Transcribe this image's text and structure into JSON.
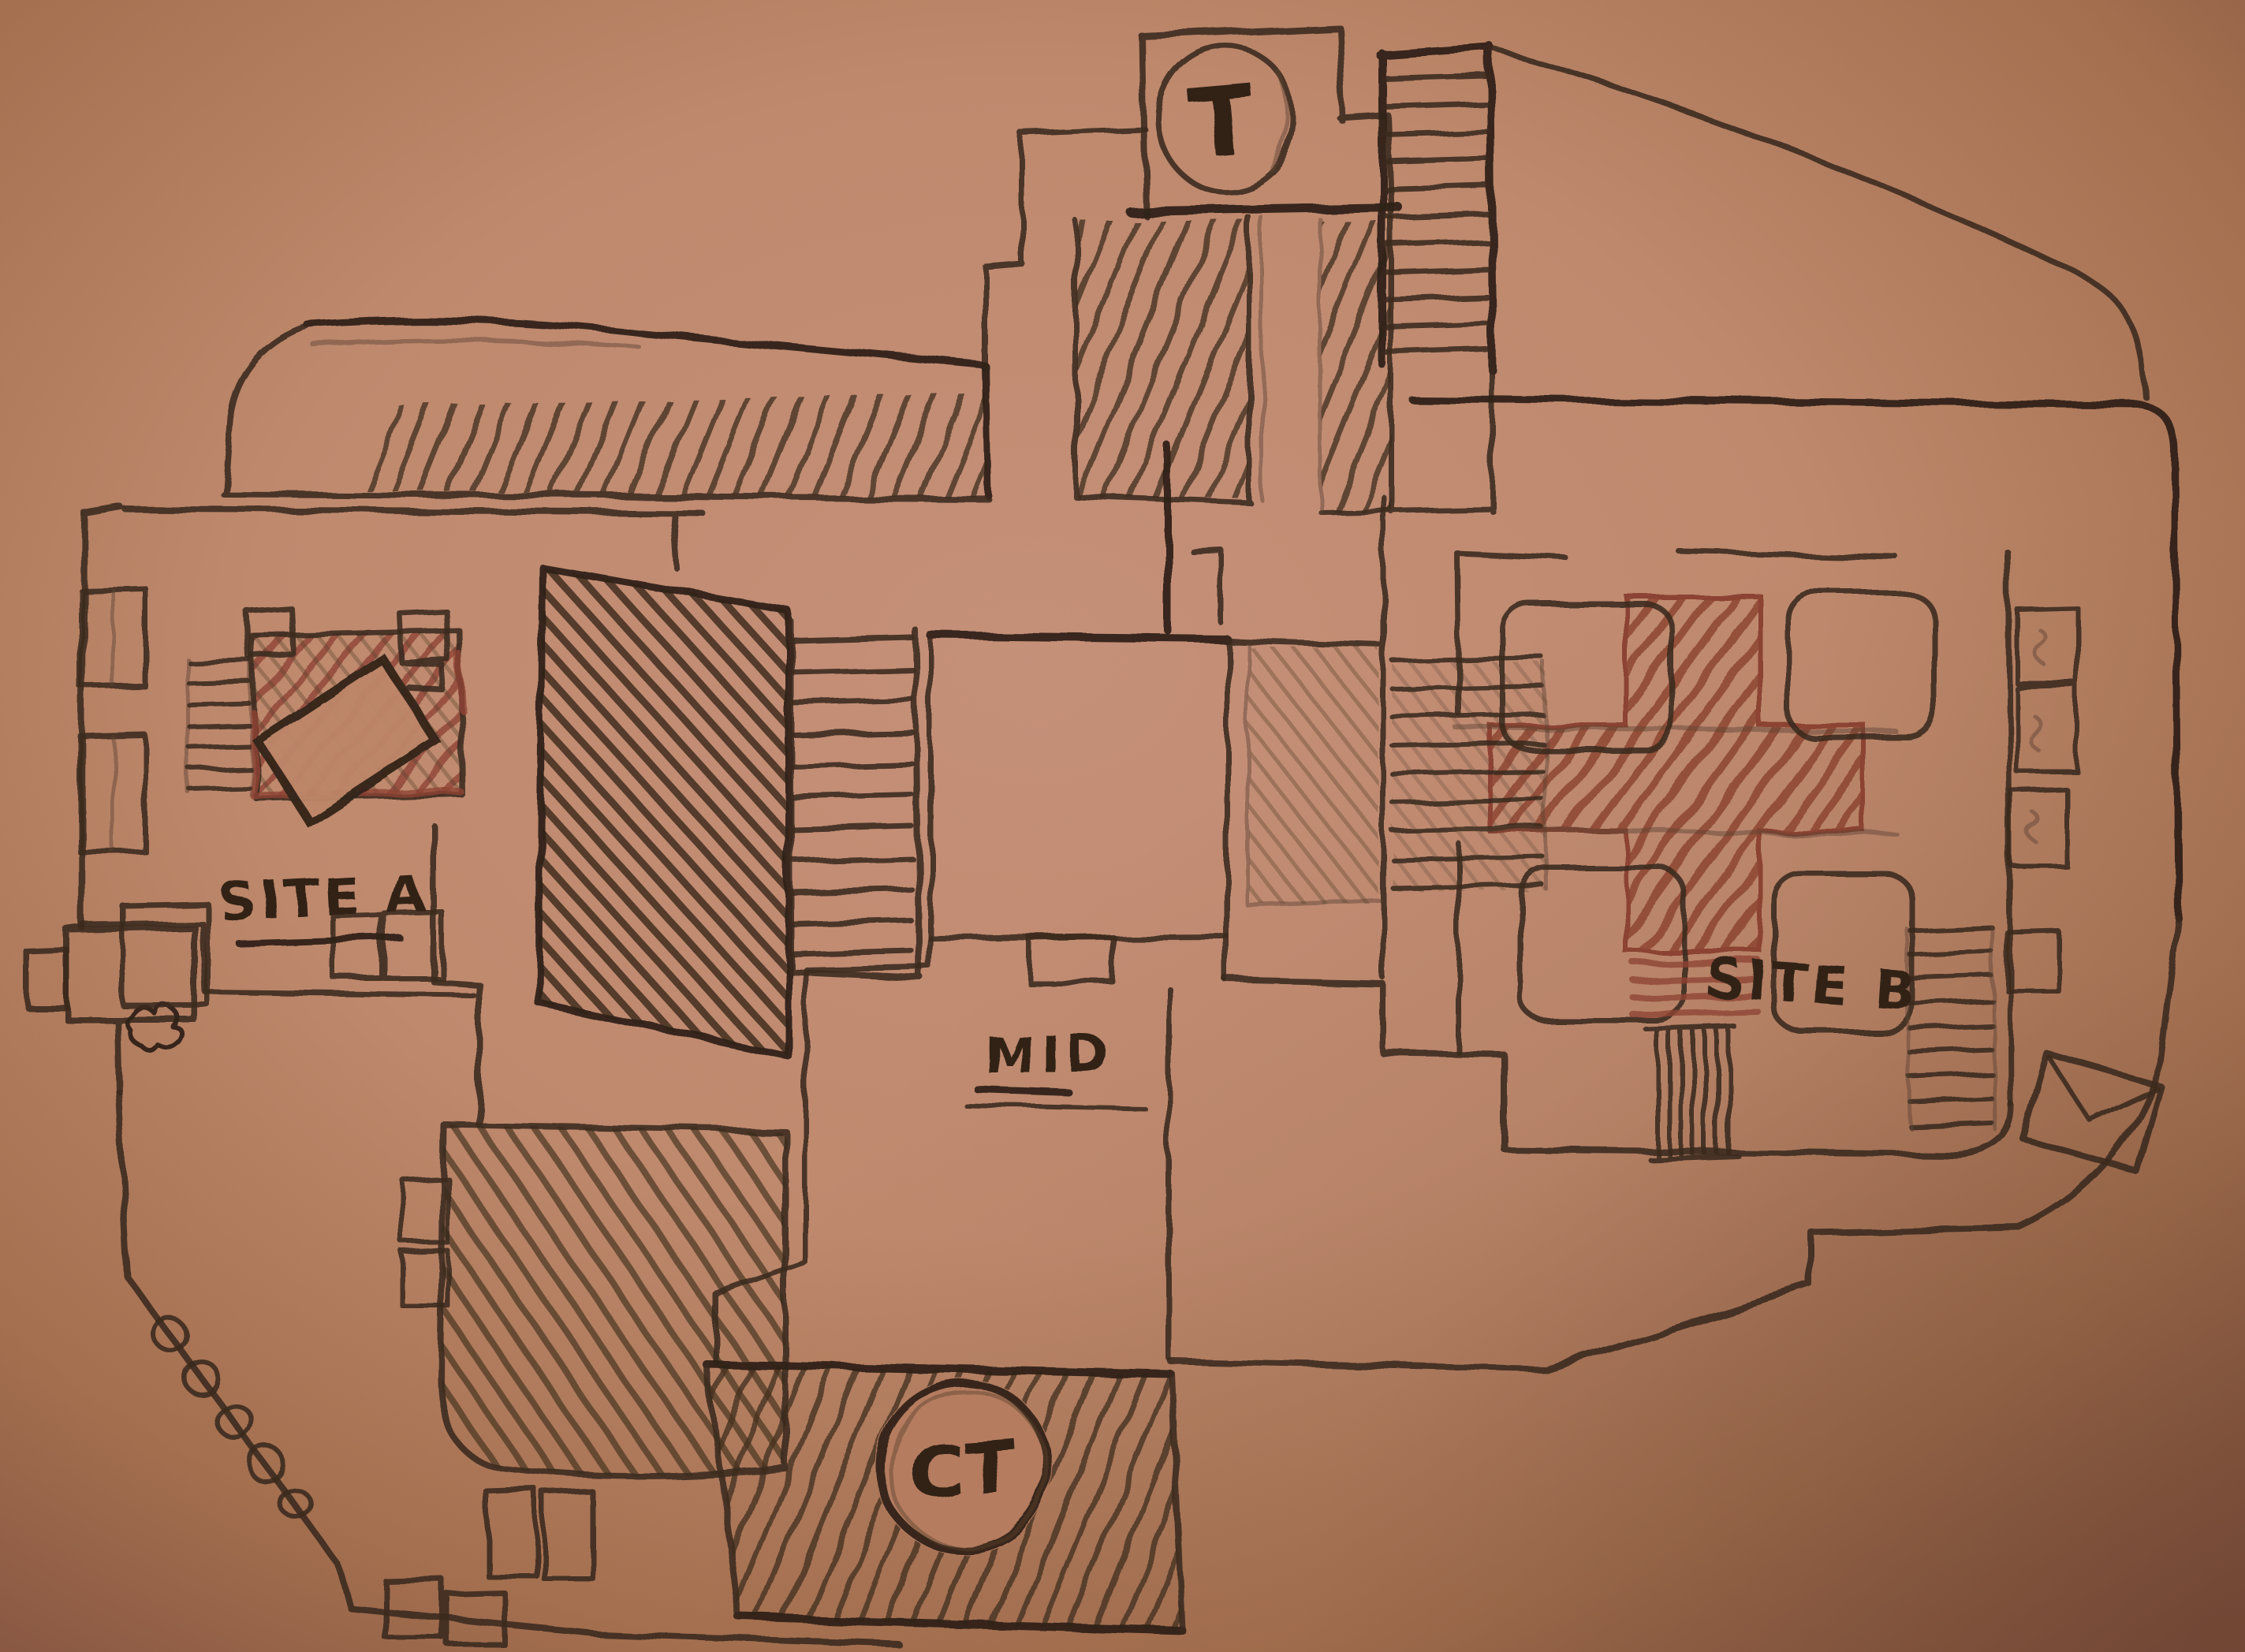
{
  "map": {
    "labels": {
      "t_spawn": "T",
      "ct_spawn": "CT",
      "site_a": "SITE A",
      "site_b": "SITE B",
      "mid": "MID"
    },
    "colors": {
      "paper": "#c08a6e",
      "paper_edge": "#855441",
      "pencil": "#3a2a1e",
      "red_marker": "#8e4434"
    }
  }
}
